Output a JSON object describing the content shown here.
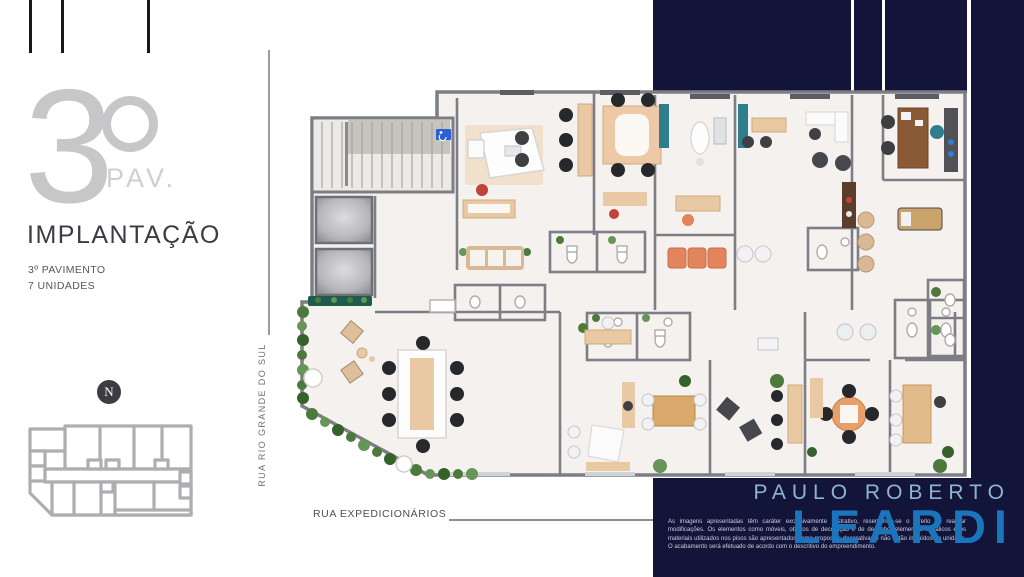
{
  "palette": {
    "navy": "#121539",
    "brand_light_blue": "#8fb3d2",
    "brand_blue": "#1b75bc",
    "heading_gray": "#c7c7c9",
    "text_dark": "#3b3b44",
    "text_medium": "#55555d",
    "street_text": "#6f6f78",
    "wall_gray": "#7d7d85",
    "floor": "#f4f1ee"
  },
  "left_panel": {
    "floor_number": "3",
    "floor_ordinal": "º",
    "floor_suffix": "PAV.",
    "title": "IMPLANTAÇÃO",
    "detail_line1": "3º PAVIMENTO",
    "detail_line2": "7 UNIDADES",
    "compass_letter": "N"
  },
  "streets": {
    "left_vertical": "RUA RIO GRANDE DO SUL",
    "bottom_horizontal": "RUA EXPEDICIONÁRIOS"
  },
  "branding": {
    "name_line1": "PAULO ROBERTO",
    "name_line2": "LEARDI"
  },
  "disclaimer": {
    "text": "As imagens apresentadas têm caráter exclusivamente ilustrativo, reservando-se o direito de realizar modificações. Os elementos como móveis, objetos de decoração e de desenho, elementos metálicos e os materiais utilizados nos pisos são apresentados como propostas decorativas e não estão incluídos na unidade. O acabamento será efetuado de acordo com o descritivo do empreendimento."
  }
}
